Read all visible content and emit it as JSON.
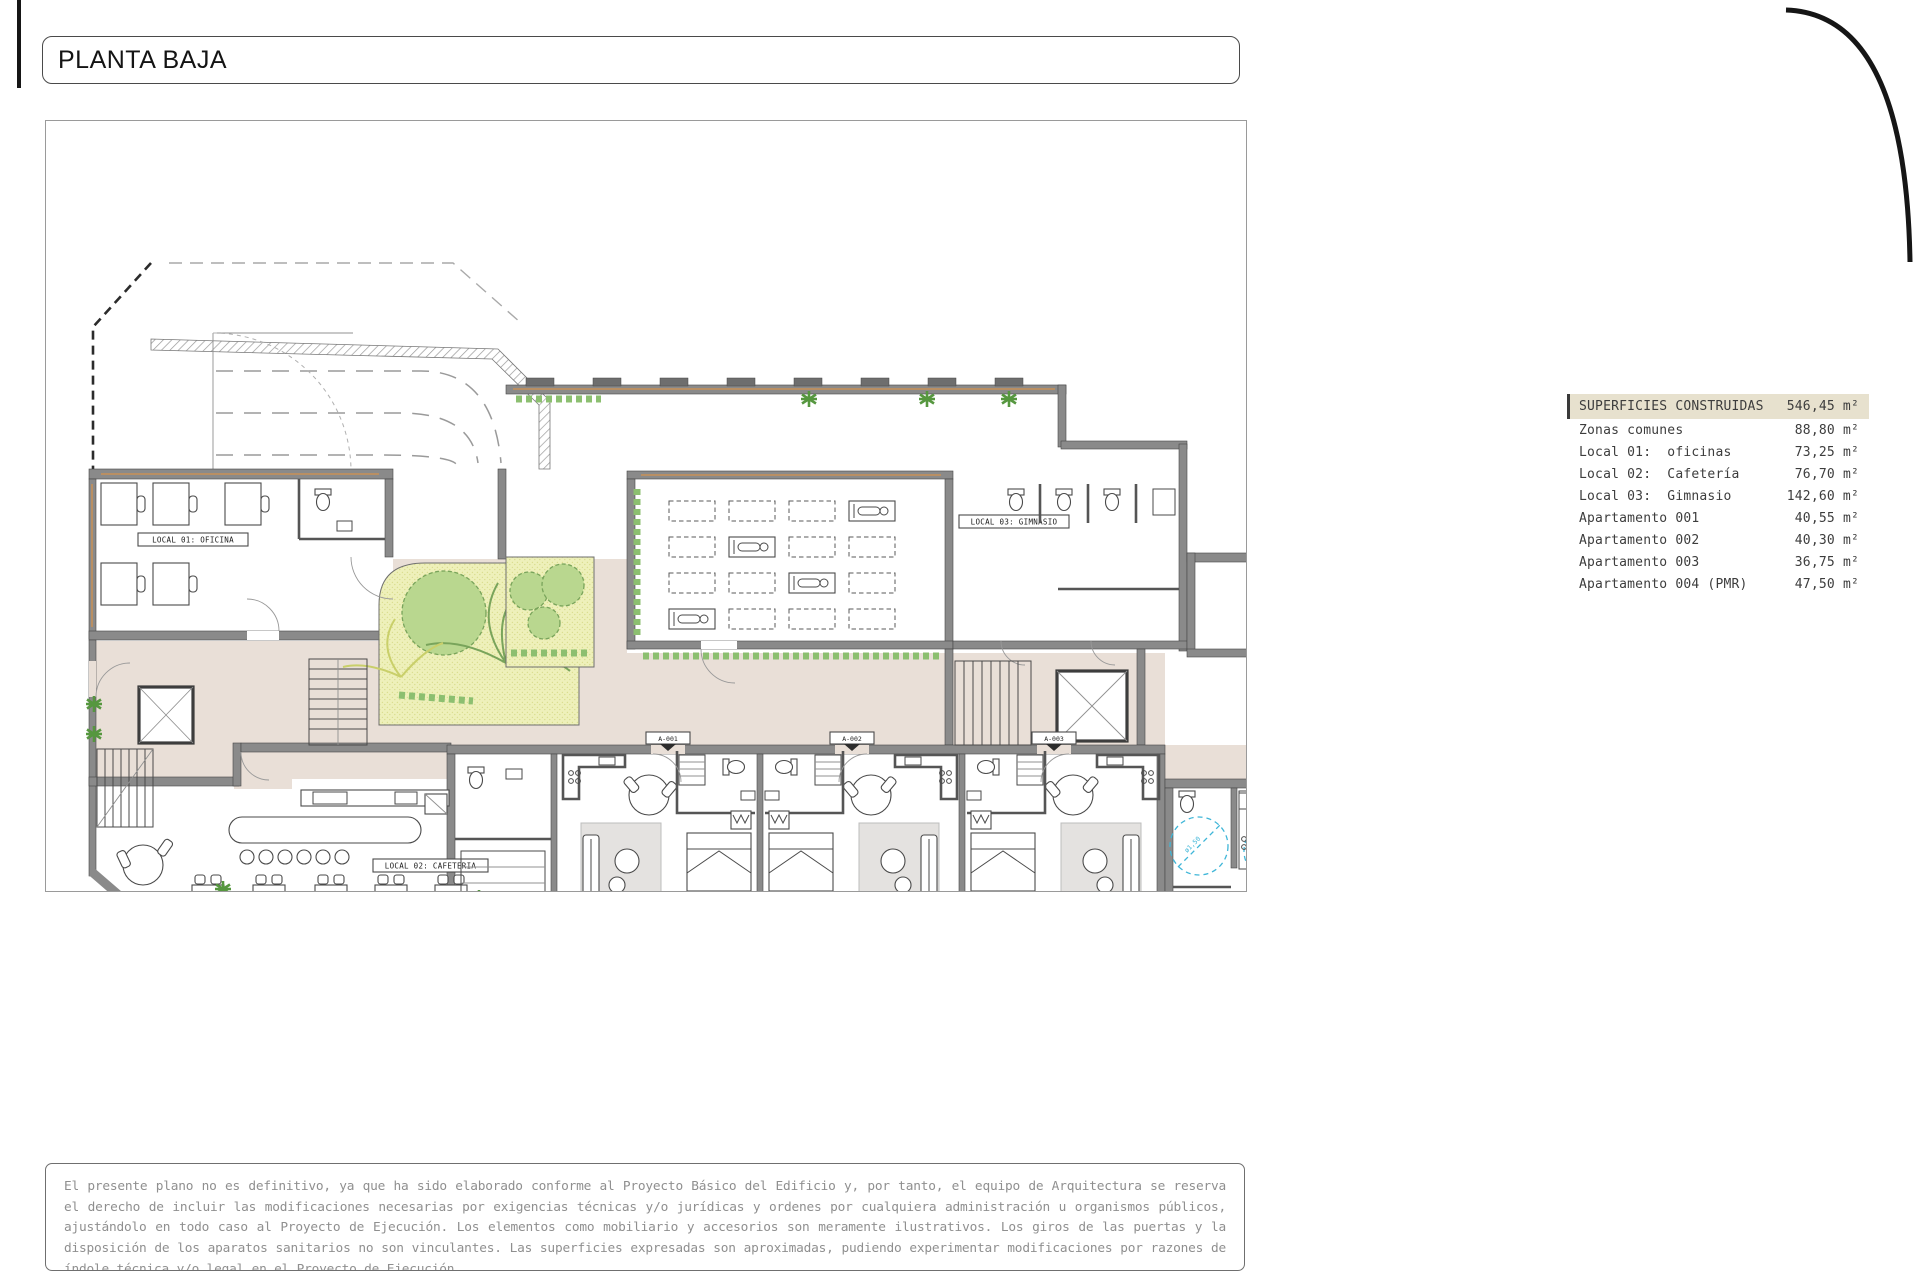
{
  "title": "PLANTA BAJA",
  "areas_table": {
    "header": {
      "label": "SUPERFICIES CONSTRUIDAS",
      "value": "546,45 m²"
    },
    "rows": [
      {
        "label": "Zonas comunes",
        "value": "88,80 m²"
      },
      {
        "label": "Local 01:  oficinas",
        "value": "73,25 m²"
      },
      {
        "label": "Local 02:  Cafetería",
        "value": "76,70 m²"
      },
      {
        "label": "Local 03:  Gimnasio",
        "value": "142,60 m²"
      },
      {
        "label": "Apartamento 001",
        "value": "40,55 m²"
      },
      {
        "label": "Apartamento 002",
        "value": "40,30 m²"
      },
      {
        "label": "Apartamento 003",
        "value": "36,75 m²"
      },
      {
        "label": "Apartamento 004 (PMR)",
        "value": "47,50 m²"
      }
    ]
  },
  "plan": {
    "room_labels": {
      "local01": "LOCAL 01: OFICINA",
      "local02": "LOCAL 02: CAFETERIA",
      "local03": "LOCAL 03: GIMNASIO"
    },
    "apartment_tags": {
      "a001": "A-001",
      "a002": "A-002",
      "a003": "A-003",
      "a004": "A-004"
    },
    "ct_note": "espacio cedido para CT",
    "accessibility_radius": "ø1,50",
    "north_letter": "N",
    "scale": {
      "tick_2": "2",
      "tick_6": "6",
      "tick_10": "10m"
    }
  },
  "disclaimer": "El presente plano no es definitivo, ya que ha sido elaborado conforme al Proyecto Básico del Edificio y, por tanto, el equipo de Arquitectura se reserva el derecho de incluir las modificaciones necesarias por exigencias técnicas y/o jurídicas y ordenes por cualquiera administración u organismos públicos, ajustándolo en todo caso al Proyecto de Ejecución. Los elementos como mobiliario y accesorios son meramente ilustrativos. Los giros de las puertas y la disposición de los aparatos sanitarios no son vinculantes. Las superficies expresadas son aproximadas, pudiendo experimentar modificaciones por razones de índole técnica y/o legal en el Proyecto de Ejecución."
}
